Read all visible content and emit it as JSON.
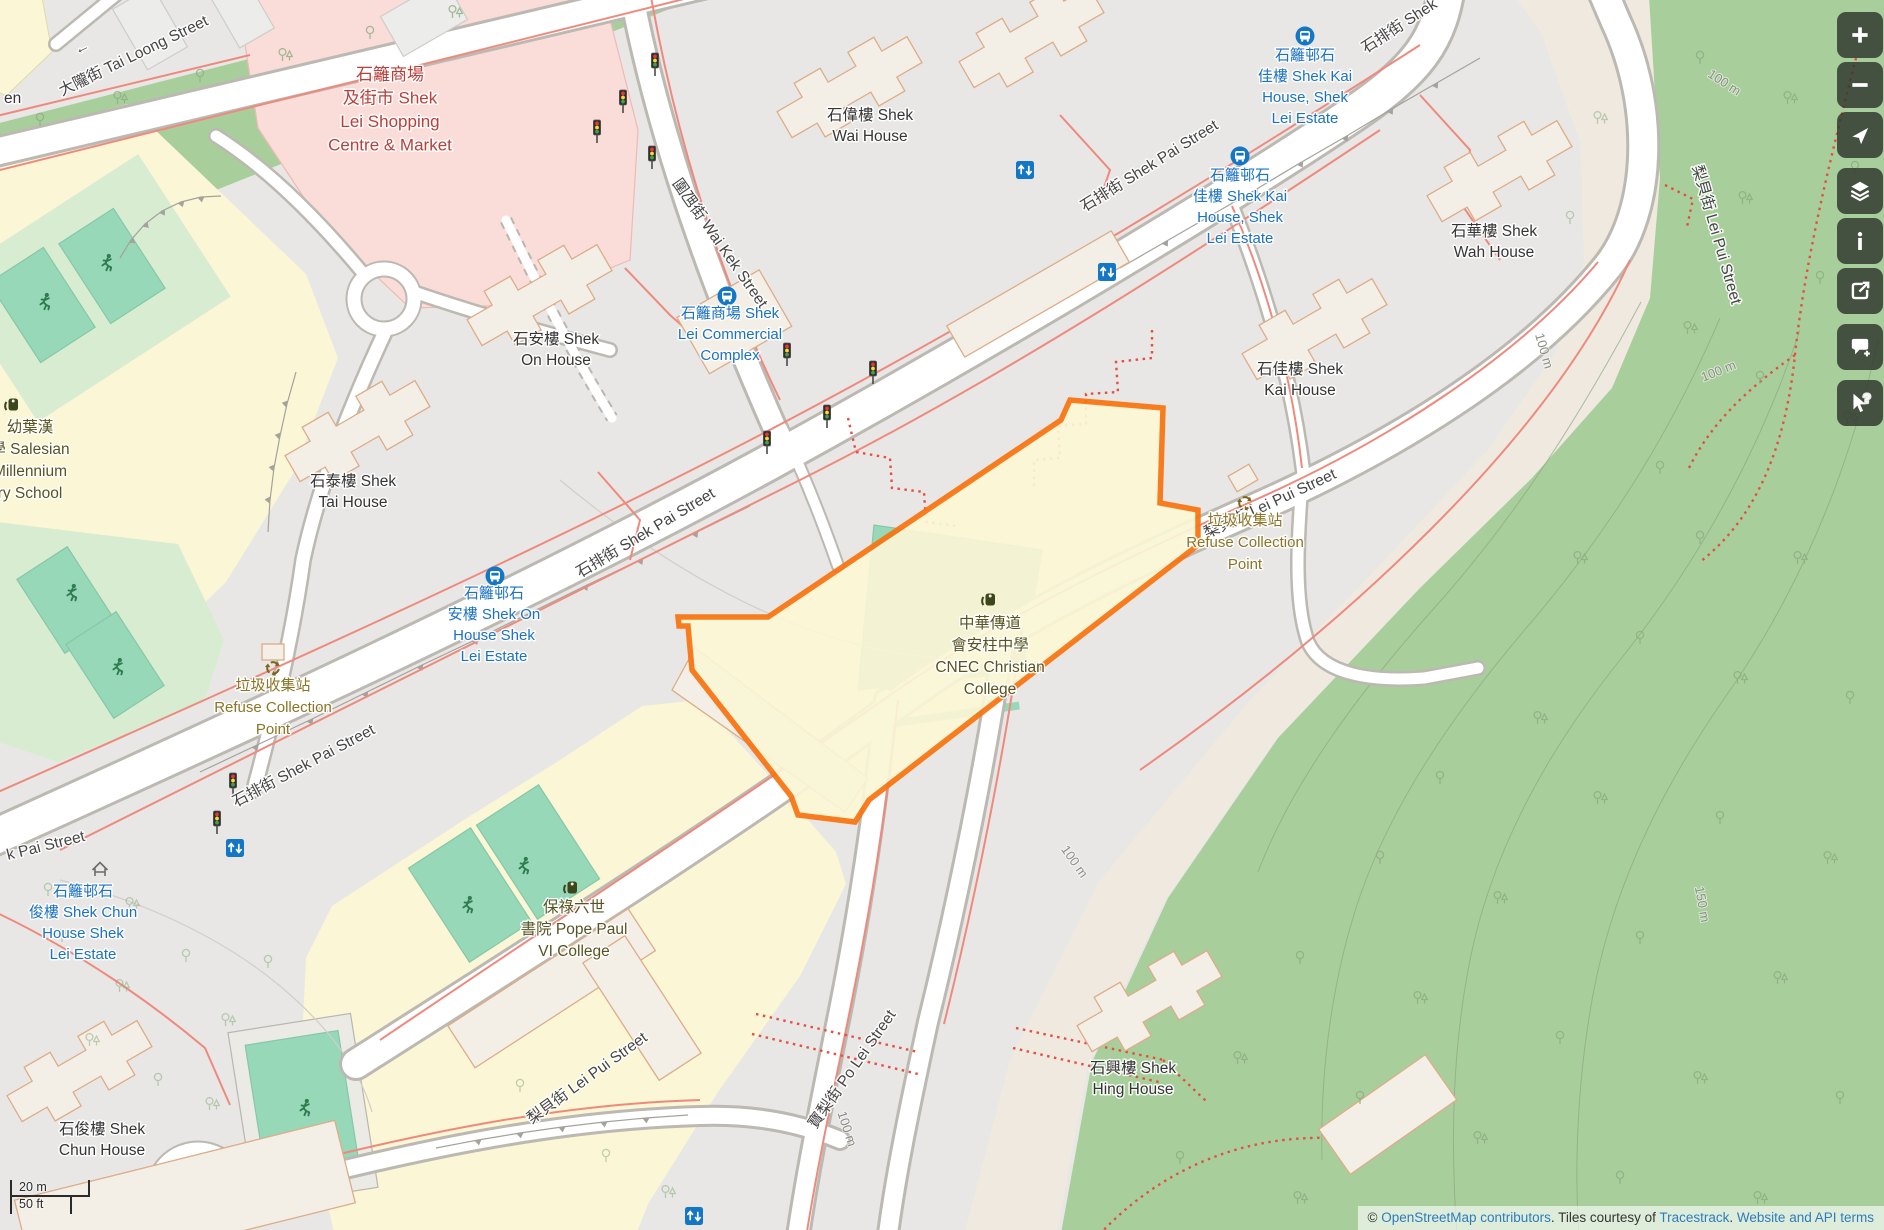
{
  "colors": {
    "highlight_outline": "#f87411",
    "forest": "#a8cf9b",
    "grass": "#d8ecd2",
    "pitch": "#97d8b9",
    "school_area": "#faf6d6",
    "retail_area": "#fadcd9",
    "slope": "#efe9df",
    "base": "#e8e7e5",
    "bus_blue": "#1477c6",
    "link_blue": "#2e7bbf",
    "fence_red": "#ee8a7d"
  },
  "map": {
    "labels": [
      {
        "n": "street-tai-loong",
        "lines": [
          "大隴街 Tai Loong Street"
        ],
        "x": 62,
        "y": 96,
        "rot": -26,
        "cls": "street",
        "anchor": "start"
      },
      {
        "n": "oneway-arrow",
        "lines": [
          "←"
        ],
        "x": 84,
        "y": 52,
        "rot": -26,
        "cls": "street"
      },
      {
        "n": "street-wai-kek",
        "lines": [
          "圍乪街 Wai Kek Street"
        ],
        "x": 716,
        "y": 246,
        "rot": 55,
        "cls": "street"
      },
      {
        "n": "street-shek-pai-1",
        "lines": [
          "石排街 Shek Pai Street"
        ],
        "x": 648,
        "y": 537,
        "rot": -31,
        "cls": "street"
      },
      {
        "n": "street-shek-pai-2",
        "lines": [
          "石排街 Shek Pai Street"
        ],
        "x": 1152,
        "y": 170,
        "rot": -32,
        "cls": "street"
      },
      {
        "n": "street-shek-pai-3",
        "lines": [
          "石排街 Shek"
        ],
        "x": 1402,
        "y": 30,
        "rot": -33,
        "cls": "street"
      },
      {
        "n": "street-shek-pai-4",
        "lines": [
          "石排街 Shek Pai Street"
        ],
        "x": 306,
        "y": 770,
        "rot": -28,
        "cls": "street"
      },
      {
        "n": "street-shek-pai-frag",
        "lines": [
          "k Pai Street"
        ],
        "x": 8,
        "y": 860,
        "rot": -14,
        "cls": "street",
        "anchor": "start"
      },
      {
        "n": "street-lei-pui-1",
        "lines": [
          "梨貝街 Lei Pui Street"
        ],
        "x": 590,
        "y": 1082,
        "rot": -36,
        "cls": "street"
      },
      {
        "n": "street-lei-pui-2",
        "lines": [
          "梨貝街 Lei Pui Street"
        ],
        "x": 1272,
        "y": 508,
        "rot": -25,
        "cls": "street"
      },
      {
        "n": "street-lei-pui-3",
        "lines": [
          "梨貝街 Lei Pui Street"
        ],
        "x": 1712,
        "y": 236,
        "rot": 74,
        "cls": "street"
      },
      {
        "n": "street-po-lei",
        "lines": [
          "寶梨街 Po Lei Street"
        ],
        "x": 856,
        "y": 1072,
        "rot": -55,
        "cls": "street"
      },
      {
        "n": "place-shek-wai",
        "lines": [
          "石偉樓 Shek",
          "Wai House"
        ],
        "x": 870,
        "y": 120,
        "rot": 0,
        "cls": "place"
      },
      {
        "n": "place-shek-wah",
        "lines": [
          "石華樓 Shek",
          "Wah House"
        ],
        "x": 1494,
        "y": 236,
        "rot": 0,
        "cls": "place"
      },
      {
        "n": "place-shek-kai",
        "lines": [
          "石佳樓 Shek",
          "Kai House"
        ],
        "x": 1300,
        "y": 374,
        "rot": 0,
        "cls": "place"
      },
      {
        "n": "place-shek-on",
        "lines": [
          "石安樓 Shek",
          "On House"
        ],
        "x": 556,
        "y": 344,
        "rot": 0,
        "cls": "place"
      },
      {
        "n": "place-shek-tai",
        "lines": [
          "石泰樓 Shek",
          "Tai House"
        ],
        "x": 353,
        "y": 486,
        "rot": 0,
        "cls": "place"
      },
      {
        "n": "place-shek-chun",
        "lines": [
          "石俊樓 Shek",
          "Chun House"
        ],
        "x": 102,
        "y": 1134,
        "rot": 0,
        "cls": "place"
      },
      {
        "n": "place-shek-hing",
        "lines": [
          "石興樓 Shek",
          "Hing House"
        ],
        "x": 1133,
        "y": 1073,
        "rot": 0,
        "cls": "place"
      },
      {
        "n": "place-fragment-en",
        "lines": [
          "en"
        ],
        "x": 4,
        "y": 103,
        "rot": 0,
        "cls": "place",
        "anchor": "start"
      },
      {
        "n": "retail-shek-lei-shopping",
        "lines": [
          "石籬商場",
          "及街市 Shek",
          "Lei Shopping",
          "Centre & Market"
        ],
        "x": 390,
        "y": 80,
        "rot": 0,
        "cls": "retail"
      },
      {
        "n": "school-salesian",
        "lines": [
          "幼葉漢",
          "學 Salesian",
          "Millennium",
          "ry School"
        ],
        "x": 30,
        "y": 432,
        "rot": 0,
        "cls": "school"
      },
      {
        "n": "school-cnec",
        "lines": [
          "中華傳道",
          "會安柱中學",
          "CNEC Christian",
          "College"
        ],
        "x": 990,
        "y": 628,
        "rot": 0,
        "cls": "school"
      },
      {
        "n": "school-pope-paul",
        "lines": [
          "保祿六世",
          "書院 Pope Paul",
          "VI College"
        ],
        "x": 574,
        "y": 912,
        "rot": 0,
        "cls": "school"
      },
      {
        "n": "refuse-point-left",
        "lines": [
          "垃圾收集站",
          "Refuse Collection",
          "Point"
        ],
        "x": 273,
        "y": 690,
        "rot": 0,
        "cls": "refuse"
      },
      {
        "n": "refuse-point-right",
        "lines": [
          "垃圾收集站",
          "Refuse Collection",
          "Point"
        ],
        "x": 1245,
        "y": 525,
        "rot": 0,
        "cls": "refuse"
      },
      {
        "n": "busstop-shek-kai-1",
        "lines": [
          "石籬邨石",
          "佳樓 Shek Kai",
          "House, Shek",
          "Lei Estate"
        ],
        "x": 1305,
        "y": 60,
        "rot": 0,
        "cls": "bus"
      },
      {
        "n": "busstop-shek-kai-2",
        "lines": [
          "石籬邨石",
          "佳樓 Shek Kai",
          "House, Shek",
          "Lei Estate"
        ],
        "x": 1240,
        "y": 180,
        "rot": 0,
        "cls": "bus"
      },
      {
        "n": "busstop-commercial-complex",
        "lines": [
          "石籬商場 Shek",
          "Lei Commercial",
          "Complex"
        ],
        "x": 730,
        "y": 318,
        "rot": 0,
        "cls": "bus"
      },
      {
        "n": "busstop-shek-on",
        "lines": [
          "石籬邨石",
          "安樓 Shek On",
          "House Shek",
          "Lei Estate"
        ],
        "x": 494,
        "y": 598,
        "rot": 0,
        "cls": "bus"
      },
      {
        "n": "busstop-shek-chun",
        "lines": [
          "石籬邨石",
          "俊樓 Shek Chun",
          "House Shek",
          "Lei Estate"
        ],
        "x": 83,
        "y": 896,
        "rot": 0,
        "cls": "bus"
      },
      {
        "n": "contour-100m-1",
        "lines": [
          "100 m"
        ],
        "x": 1722,
        "y": 86,
        "rot": 33,
        "cls": "contour"
      },
      {
        "n": "contour-100m-2",
        "lines": [
          "100 m"
        ],
        "x": 1720,
        "y": 375,
        "rot": -22,
        "cls": "contour"
      },
      {
        "n": "contour-100m-3",
        "lines": [
          "100 m"
        ],
        "x": 1540,
        "y": 352,
        "rot": 74,
        "cls": "contour"
      },
      {
        "n": "contour-100m-4",
        "lines": [
          "100 m"
        ],
        "x": 1071,
        "y": 864,
        "rot": 55,
        "cls": "contour"
      },
      {
        "n": "contour-100m-5",
        "lines": [
          "100 m"
        ],
        "x": 843,
        "y": 1130,
        "rot": 72,
        "cls": "contour"
      },
      {
        "n": "contour-150m",
        "lines": [
          "150 m"
        ],
        "x": 1698,
        "y": 905,
        "rot": 80,
        "cls": "contour"
      }
    ],
    "icons": [
      {
        "t": "bus",
        "x": 1305,
        "y": 36
      },
      {
        "t": "bus",
        "x": 1240,
        "y": 156
      },
      {
        "t": "bus",
        "x": 727,
        "y": 296
      },
      {
        "t": "bus",
        "x": 495,
        "y": 576
      },
      {
        "t": "elevator",
        "x": 1025,
        "y": 170
      },
      {
        "t": "elevator",
        "x": 1107,
        "y": 272
      },
      {
        "t": "elevator",
        "x": 235,
        "y": 848
      },
      {
        "t": "elevator",
        "x": 694,
        "y": 1216
      },
      {
        "t": "recycle",
        "x": 273,
        "y": 668
      },
      {
        "t": "recycle",
        "x": 1245,
        "y": 503
      },
      {
        "t": "school",
        "x": 13,
        "y": 405
      },
      {
        "t": "school",
        "x": 572,
        "y": 888
      },
      {
        "t": "school",
        "x": 990,
        "y": 600
      },
      {
        "t": "shelter",
        "x": 100,
        "y": 869
      },
      {
        "t": "runner",
        "x": 45,
        "y": 302
      },
      {
        "t": "runner",
        "x": 107,
        "y": 263
      },
      {
        "t": "runner",
        "x": 72,
        "y": 593
      },
      {
        "t": "runner",
        "x": 118,
        "y": 667
      },
      {
        "t": "runner",
        "x": 468,
        "y": 905
      },
      {
        "t": "runner",
        "x": 524,
        "y": 866
      },
      {
        "t": "runner",
        "x": 305,
        "y": 1108
      },
      {
        "t": "traffic",
        "x": 655,
        "y": 65
      },
      {
        "t": "traffic",
        "x": 623,
        "y": 102
      },
      {
        "t": "traffic",
        "x": 597,
        "y": 132
      },
      {
        "t": "traffic",
        "x": 652,
        "y": 158
      },
      {
        "t": "traffic",
        "x": 787,
        "y": 355
      },
      {
        "t": "traffic",
        "x": 873,
        "y": 373
      },
      {
        "t": "traffic",
        "x": 767,
        "y": 443
      },
      {
        "t": "traffic",
        "x": 827,
        "y": 417
      },
      {
        "t": "traffic",
        "x": 233,
        "y": 785
      },
      {
        "t": "traffic",
        "x": 217,
        "y": 823
      }
    ]
  },
  "controls": {
    "buttons": [
      {
        "name": "zoom-in-button",
        "icon": "plus"
      },
      {
        "name": "zoom-out-button",
        "icon": "minus"
      },
      {
        "name": "locate-button",
        "icon": "locate"
      },
      {
        "name": "layers-button",
        "icon": "layers"
      },
      {
        "name": "map-key-button",
        "icon": "info"
      },
      {
        "name": "share-button",
        "icon": "share"
      },
      {
        "name": "add-note-button",
        "icon": "note"
      },
      {
        "name": "query-features-button",
        "icon": "query"
      }
    ]
  },
  "scalebar": {
    "metric": "20 m",
    "imperial": "50 ft"
  },
  "attribution": {
    "prefix": "© ",
    "osm_link": "OpenStreetMap contributors",
    "mid1": ". Tiles courtesy of ",
    "tiles_link": "Tracestrack",
    "mid2": ". ",
    "terms_link": "Website and API terms"
  }
}
